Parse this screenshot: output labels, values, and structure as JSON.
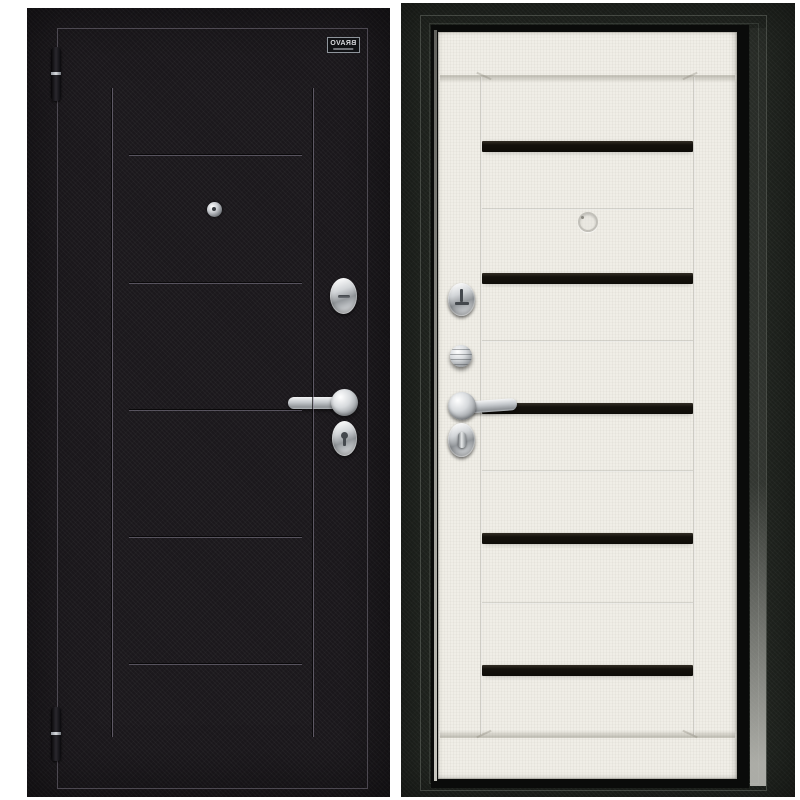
{
  "page": {
    "background": "#ffffff"
  },
  "brand_plaque": {
    "text": "BRAVO",
    "mirrored": true
  },
  "colors": {
    "page_bg": "#ffffff",
    "left_panel_bg": "#1b181c",
    "right_panel_bg": "#20241f",
    "white_door": "#f0eee7",
    "glass_insert": "#14110c",
    "plaque_bg": "#101114",
    "plaque_border": "#8e949b",
    "plaque_text": "#d9dbde",
    "chrome": "#c9ccd0",
    "leaf_outline": "#968ea0"
  },
  "left_view": {
    "label": "door-exterior-side",
    "hinges": {
      "count": 2,
      "y": [
        39,
        699
      ]
    },
    "vertical_grooves": {
      "x": [
        85,
        286
      ],
      "top": 80,
      "height": 649
    },
    "horizontal_grooves": {
      "y": [
        147,
        275,
        402,
        529,
        656
      ]
    },
    "hardware": [
      "peephole",
      "lock-cylinder-cover",
      "lever-handle",
      "keyhole-cover"
    ]
  },
  "right_view": {
    "label": "door-interior-side",
    "glass_inserts": {
      "count": 5,
      "y": [
        109,
        241,
        371,
        501,
        633
      ]
    },
    "panel_grooves": {
      "y": [
        176,
        308,
        438,
        570
      ]
    },
    "hardware": [
      "deadbolt-cover",
      "thumbturn-knob",
      "lever-handle",
      "thumbturn-cover",
      "peephole"
    ]
  }
}
